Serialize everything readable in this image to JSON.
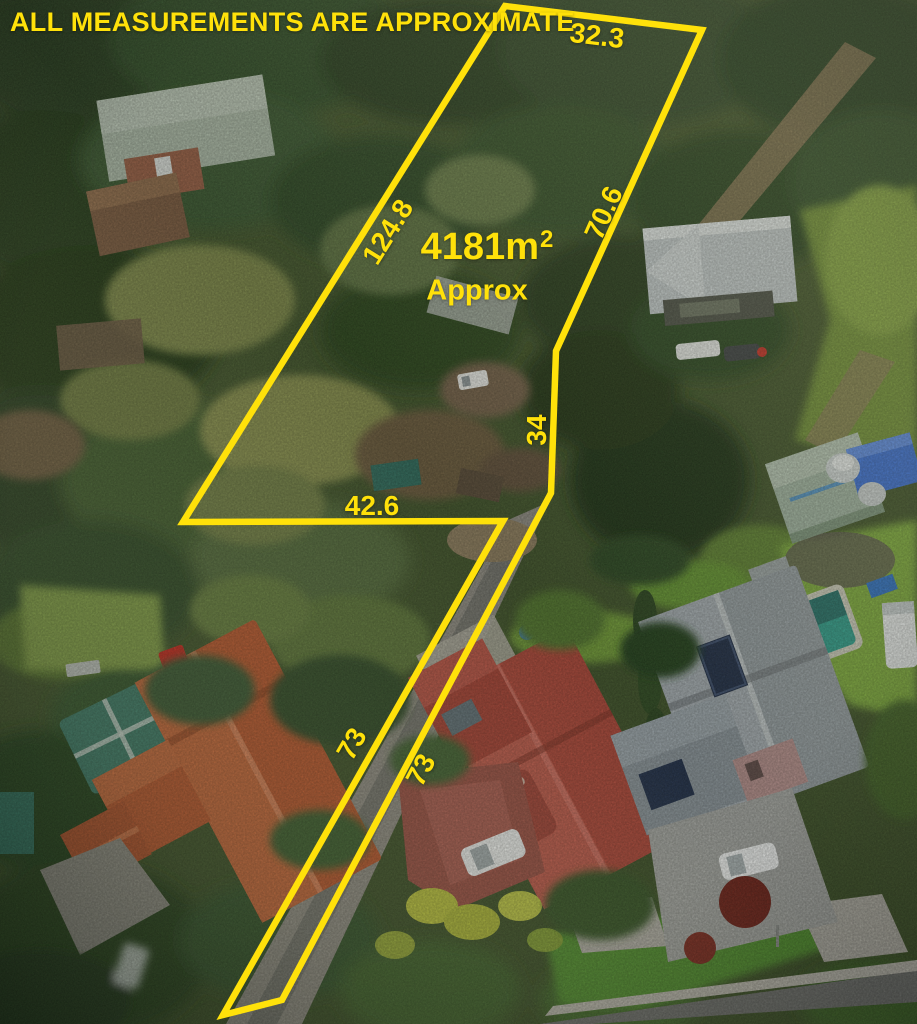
{
  "overlay": {
    "accent_color": "#FFE10A",
    "disclaimer": "ALL MEASUREMENTS ARE APPROXIMATE",
    "area": {
      "value": "4181m",
      "superscript": "2",
      "qualifier": "Approx"
    },
    "measurements": {
      "top_edge": "32.3",
      "left_edge": "124.8",
      "right_edge": "70.6",
      "inner_right_edge": "34",
      "inner_bottom_edge": "42.6",
      "driveway_left_edge": "73",
      "driveway_right_edge": "73"
    },
    "parcel_outline_points": "505,6 702,30 556,351 551,493 282,1000 223,1015 503,521 183,522"
  }
}
